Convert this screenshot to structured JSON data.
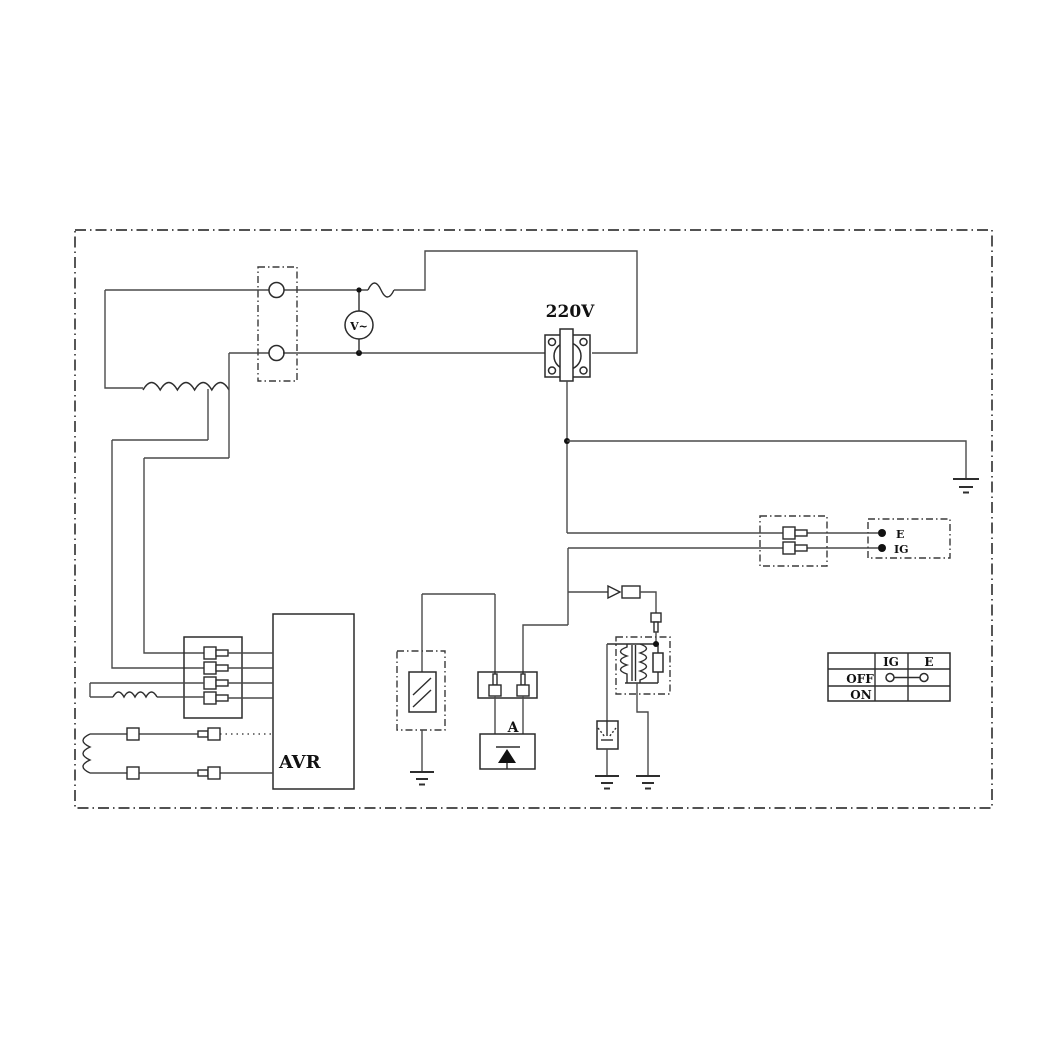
{
  "diagram": {
    "type": "wiring-schematic",
    "description": "generator wiring diagram with AVR, 220V receptacle, voltmeter, ignition coil and engine switch",
    "colors": {
      "line": "#3a3a3a",
      "background": "#ffffff",
      "text": "#111111"
    },
    "labels": {
      "outlet_voltage": "220V",
      "voltmeter": "V~",
      "avr": "AVR",
      "diode_unit": "A",
      "terminal_e": "E",
      "terminal_ig": "IG"
    },
    "switch_table": {
      "corner": "",
      "col_headers": [
        "IG",
        "E"
      ],
      "rows": [
        {
          "label": "OFF",
          "bridged": true
        },
        {
          "label": "ON",
          "bridged": false
        }
      ]
    }
  }
}
